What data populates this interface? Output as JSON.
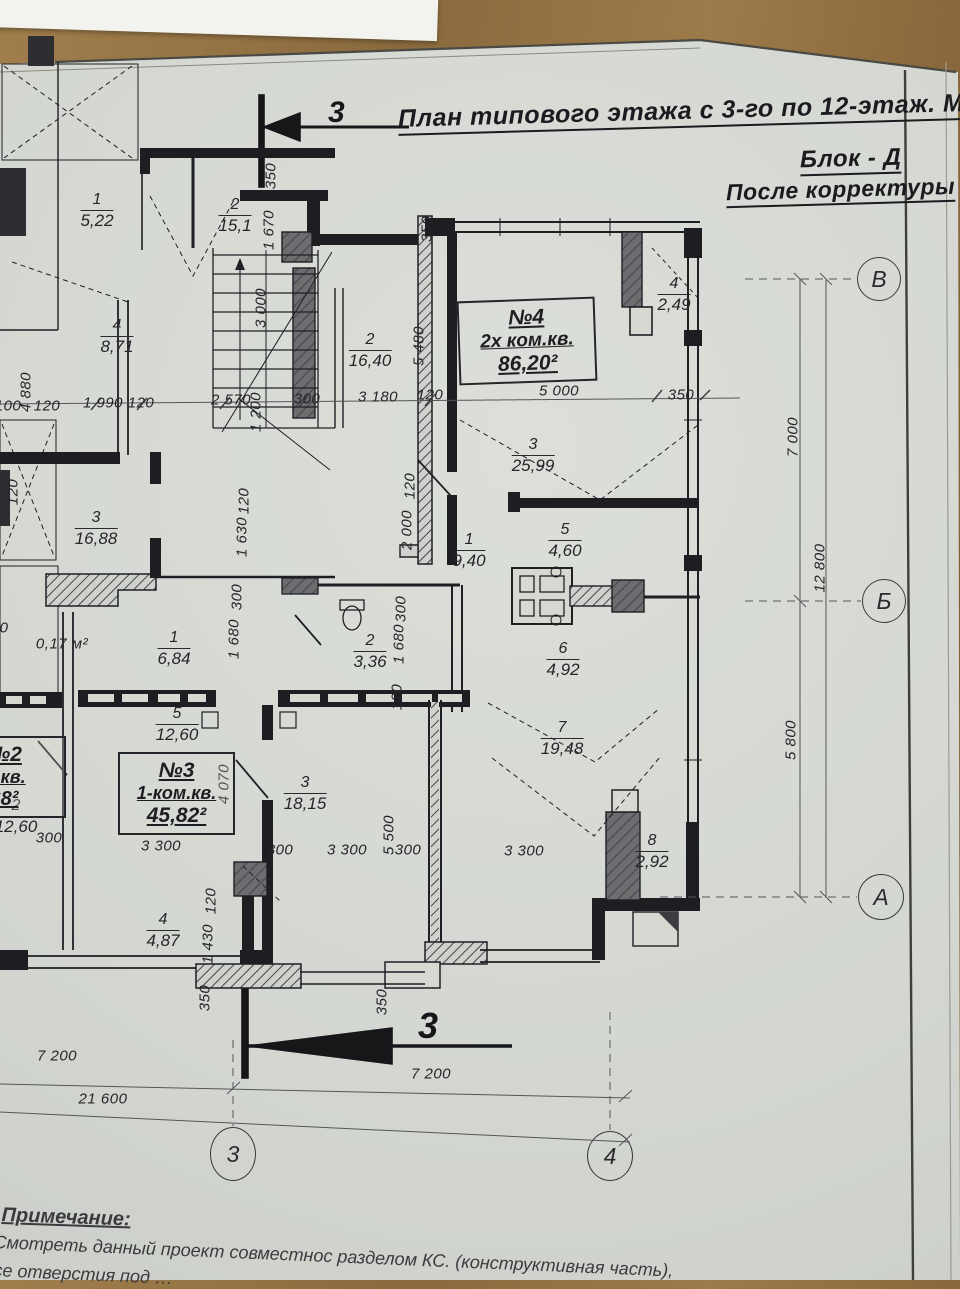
{
  "title": {
    "line1": "План типового этажа с 3-го по 12-этаж.  М1:100",
    "line2": "Блок - Д",
    "line3": "После корректуры"
  },
  "section_markers": {
    "top": "3",
    "bottom": "3"
  },
  "grid_axes": [
    {
      "label": "В",
      "x": 879,
      "y": 279,
      "w": 42,
      "h": 42
    },
    {
      "label": "Б",
      "x": 884,
      "y": 601,
      "w": 42,
      "h": 42
    },
    {
      "label": "А",
      "x": 881,
      "y": 897,
      "w": 44,
      "h": 44
    },
    {
      "label": "3",
      "x": 233,
      "y": 1154,
      "w": 44,
      "h": 52
    },
    {
      "label": "4",
      "x": 610,
      "y": 1156,
      "w": 44,
      "h": 48
    }
  ],
  "apartments": [
    {
      "lines": [
        "№4",
        "2х ком.кв.",
        "86,20²"
      ],
      "x": 458,
      "y": 299,
      "w": 118,
      "rot": -2,
      "sizes": [
        21,
        19,
        21
      ]
    },
    {
      "lines": [
        "№3",
        "1-ком.кв.",
        "45,82²"
      ],
      "x": 118,
      "y": 752,
      "w": 97,
      "rot": 0,
      "sizes": [
        21,
        18,
        21
      ]
    },
    {
      "lines": [
        "№2",
        "м.кв.",
        "68²"
      ],
      "x": -58,
      "y": 736,
      "w": 104,
      "rot": 0,
      "sizes": [
        21,
        18,
        20
      ]
    }
  ],
  "rooms": [
    {
      "num": "1",
      "area": "5,22",
      "x": 97,
      "y": 192
    },
    {
      "num": "2",
      "area": "15,1",
      "x": 235,
      "y": 197
    },
    {
      "num": "4",
      "area": "8,71",
      "x": 117,
      "y": 318
    },
    {
      "num": "2",
      "area": "16,40",
      "x": 370,
      "y": 332
    },
    {
      "num": "4",
      "area": "2,49",
      "x": 674,
      "y": 276
    },
    {
      "num": "3",
      "area": "25,99",
      "x": 533,
      "y": 437
    },
    {
      "num": "3",
      "area": "16,88",
      "x": 96,
      "y": 510
    },
    {
      "num": "1",
      "area": "9,40",
      "x": 469,
      "y": 532
    },
    {
      "num": "5",
      "area": "4,60",
      "x": 565,
      "y": 522
    },
    {
      "num": "6",
      "area": "4,92",
      "x": 563,
      "y": 641
    },
    {
      "num": "1",
      "area": "6,84",
      "x": 174,
      "y": 630
    },
    {
      "num": "2",
      "area": "3,36",
      "x": 370,
      "y": 633
    },
    {
      "num": "5",
      "area": "12,60",
      "x": 177,
      "y": 706
    },
    {
      "num": "7",
      "area": "19,48",
      "x": 562,
      "y": 720
    },
    {
      "num": "3",
      "area": "18,15",
      "x": 305,
      "y": 775
    },
    {
      "num": "8",
      "area": "2,92",
      "x": 652,
      "y": 833
    },
    {
      "num": "4",
      "area": "4,87",
      "x": 163,
      "y": 912
    },
    {
      "num": "2",
      "area": "12,60",
      "x": 16,
      "y": 798
    }
  ],
  "dims": [
    {
      "t": "100",
      "x": 8,
      "y": 406
    },
    {
      "t": "4 880",
      "x": 26,
      "y": 392,
      "r": 1
    },
    {
      "t": "120",
      "x": 47,
      "y": 406
    },
    {
      "t": "1 990",
      "x": 103,
      "y": 403
    },
    {
      "t": "120",
      "x": 141,
      "y": 403
    },
    {
      "t": "2 570",
      "x": 231,
      "y": 400
    },
    {
      "t": "300",
      "x": 307,
      "y": 399
    },
    {
      "t": "3 180",
      "x": 378,
      "y": 397
    },
    {
      "t": "120",
      "x": 430,
      "y": 395
    },
    {
      "t": "5 000",
      "x": 559,
      "y": 391
    },
    {
      "t": "350",
      "x": 681,
      "y": 395
    },
    {
      "t": "350",
      "x": 271,
      "y": 176,
      "r": 1
    },
    {
      "t": "1 670",
      "x": 269,
      "y": 230,
      "r": 1
    },
    {
      "t": "3 000",
      "x": 261,
      "y": 308,
      "r": 1
    },
    {
      "t": "1 200",
      "x": 256,
      "y": 412,
      "r": 1
    },
    {
      "t": "350",
      "x": 427,
      "y": 229,
      "r": 1
    },
    {
      "t": "5 480",
      "x": 419,
      "y": 346,
      "r": 1
    },
    {
      "t": "120",
      "x": 410,
      "y": 486,
      "r": 1
    },
    {
      "t": "2 000",
      "x": 407,
      "y": 530,
      "r": 1
    },
    {
      "t": "120",
      "x": 13,
      "y": 492,
      "r": 1
    },
    {
      "t": "120",
      "x": 244,
      "y": 501,
      "r": 1
    },
    {
      "t": "1 630",
      "x": 242,
      "y": 537,
      "r": 1
    },
    {
      "t": "300",
      "x": 237,
      "y": 597,
      "r": 1
    },
    {
      "t": "1 680",
      "x": 234,
      "y": 639,
      "r": 1
    },
    {
      "t": "0",
      "x": 4,
      "y": 628
    },
    {
      "t": "300",
      "x": 401,
      "y": 609,
      "r": 1
    },
    {
      "t": "1 680",
      "x": 399,
      "y": 644,
      "r": 1
    },
    {
      "t": "120",
      "x": 397,
      "y": 697,
      "r": 1
    },
    {
      "t": "0,17 м²",
      "x": 62,
      "y": 644
    },
    {
      "t": "300",
      "x": 49,
      "y": 838
    },
    {
      "t": "3 300",
      "x": 161,
      "y": 846
    },
    {
      "t": "4 070",
      "x": 224,
      "y": 784,
      "r": 1
    },
    {
      "t": "300",
      "x": 280,
      "y": 850
    },
    {
      "t": "3 300",
      "x": 347,
      "y": 850
    },
    {
      "t": "5 500",
      "x": 389,
      "y": 835,
      "r": 1
    },
    {
      "t": "300",
      "x": 408,
      "y": 850
    },
    {
      "t": "3 300",
      "x": 524,
      "y": 851
    },
    {
      "t": "120",
      "x": 211,
      "y": 901,
      "r": 1
    },
    {
      "t": "1 430",
      "x": 208,
      "y": 944,
      "r": 1
    },
    {
      "t": "350",
      "x": 205,
      "y": 998,
      "r": 1
    },
    {
      "t": "350",
      "x": 382,
      "y": 1002,
      "r": 1
    },
    {
      "t": "7 000",
      "x": 793,
      "y": 437,
      "r": 1
    },
    {
      "t": "12 800",
      "x": 820,
      "y": 568,
      "r": 1
    },
    {
      "t": "5 800",
      "x": 791,
      "y": 740,
      "r": 1
    },
    {
      "t": "7 200",
      "x": 57,
      "y": 1056
    },
    {
      "t": "21 600",
      "x": 103,
      "y": 1099
    },
    {
      "t": "7 200",
      "x": 431,
      "y": 1074
    }
  ],
  "notes": {
    "heading": "Примечание:",
    "line1": "Смотреть данный проект совместнос разделом КС. (конструктивная часть),",
    "line2": "се отверстия под …"
  }
}
